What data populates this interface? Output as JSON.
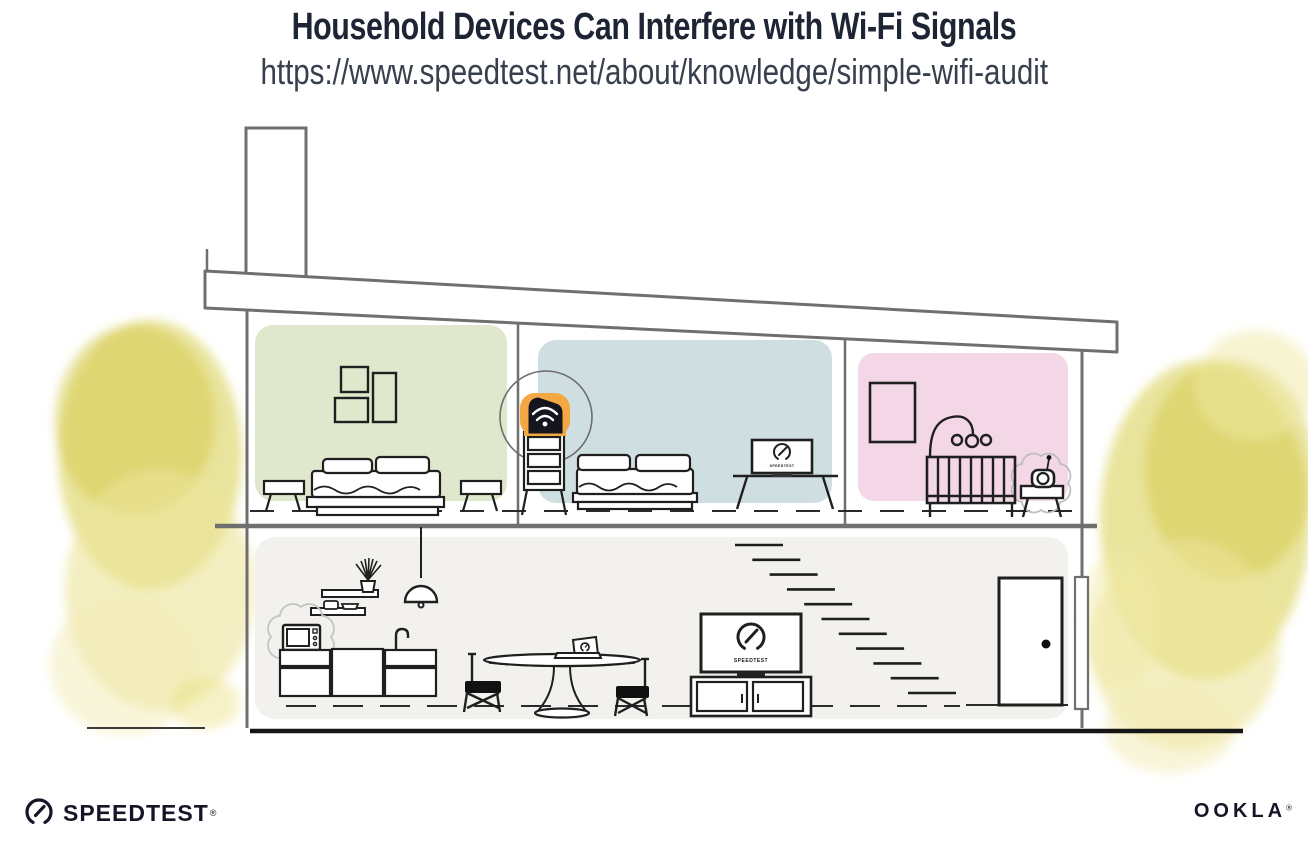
{
  "header": {
    "title": "Household Devices Can Interfere with Wi-Fi Signals",
    "url": "https://www.speedtest.net/about/knowledge/simple-wifi-audit"
  },
  "illustration": {
    "bedroom_monitor_label": "SPEEDTEST",
    "living_room_tv_label": "SPEEDTEST",
    "icons": {
      "router": "wifi-router-icon",
      "bedroom_screen": "speedtest-gauge-icon",
      "tv_screen": "speedtest-gauge-icon",
      "microwave": "microwave-icon",
      "baby_monitor": "baby-monitor-icon",
      "interference": "interference-burst"
    },
    "colors": {
      "bedroom_left_wall": "#dfe8cd",
      "bedroom_middle_wall": "#cfdfe1",
      "nursery_wall": "#f4d7e6",
      "ground_floor_wall": "#f2f1ee",
      "foliage": "#dcd45e",
      "foliage_light": "#ece59a",
      "router_highlight": "#f4a843",
      "ink": "#1a1a1a",
      "structure": "#6f6f6f"
    }
  },
  "footer": {
    "speedtest_label": "SPEEDTEST",
    "speedtest_reg": "®",
    "ookla_label": "OOKLA",
    "ookla_reg": "®"
  }
}
